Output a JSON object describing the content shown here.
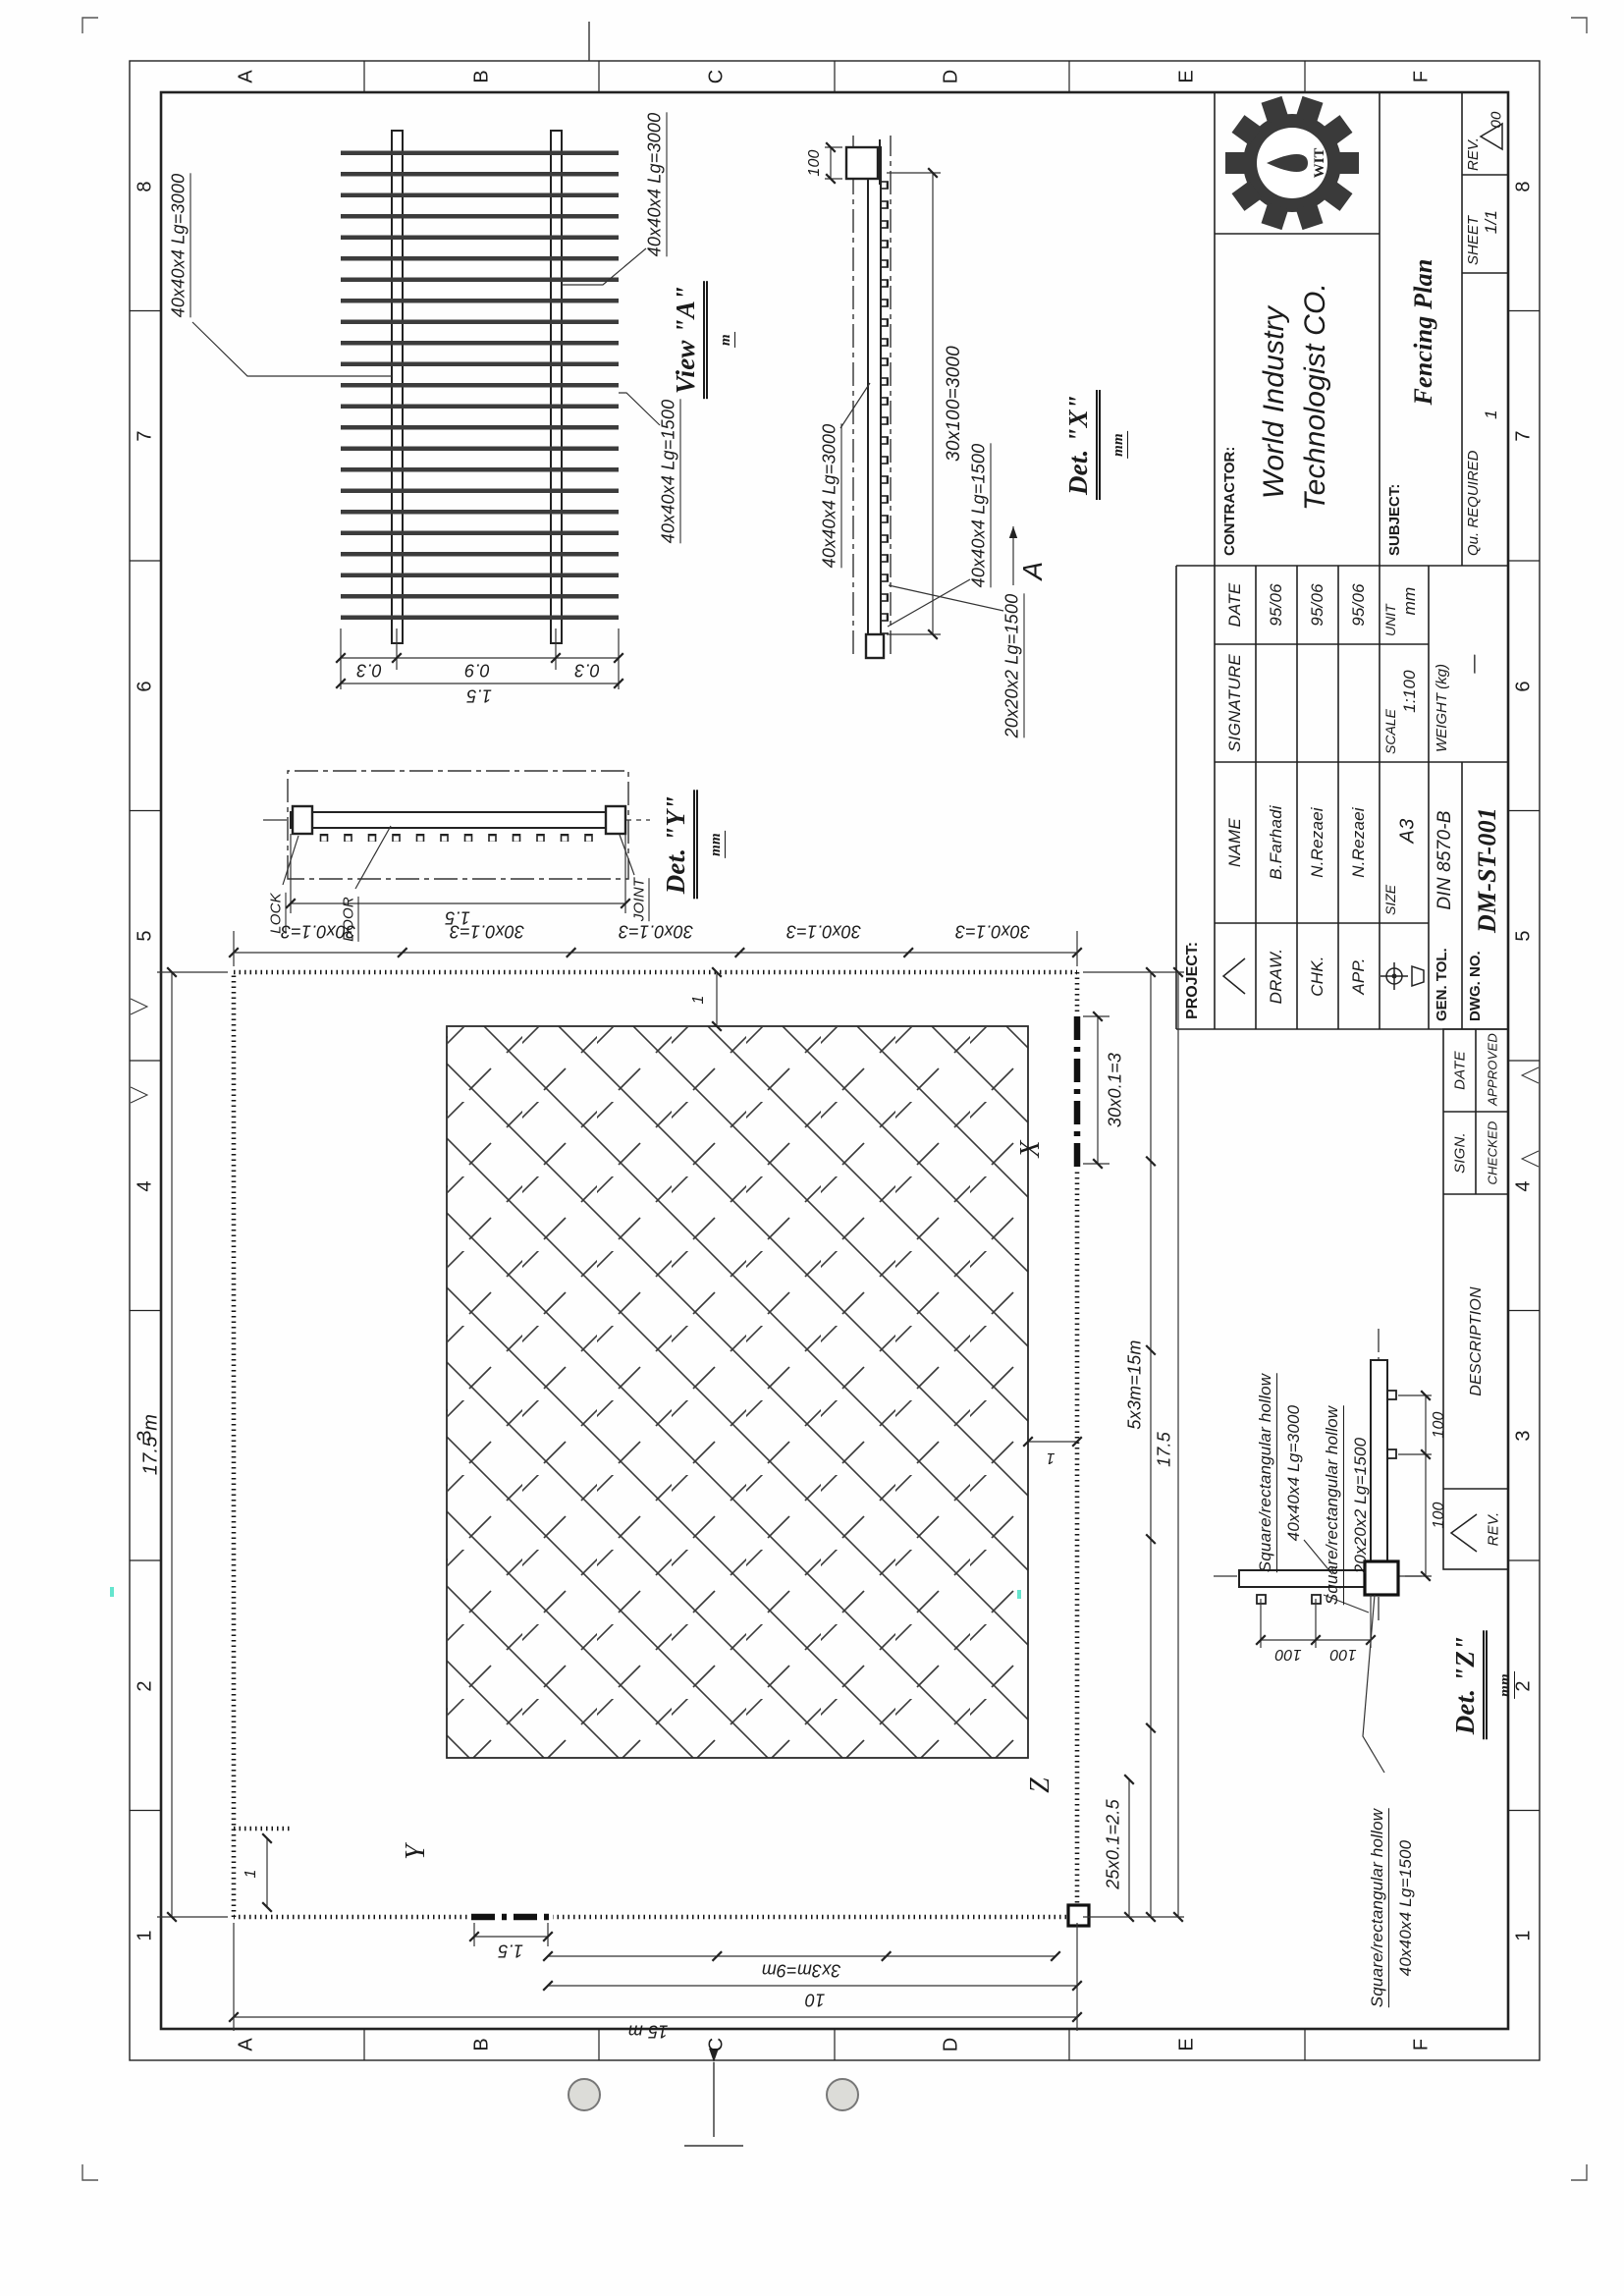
{
  "sheet": {
    "grid_letters": [
      "A",
      "B",
      "C",
      "D",
      "E",
      "F"
    ],
    "grid_numbers": [
      "1",
      "2",
      "3",
      "4",
      "5",
      "6",
      "7",
      "8"
    ]
  },
  "title_block": {
    "project_label": "PROJECT:",
    "contractor_label": "CONTRACTOR:",
    "contractor_name_line1": "World Industry",
    "contractor_name_line2": "Technologist CO.",
    "logo_text": "WIT",
    "logo_icon": "gear-drop-icon",
    "subject_label": "SUBJECT:",
    "subject_value": "Fencing Plan",
    "table": {
      "name_header": "NAME",
      "signature_header": "SIGNATURE",
      "date_header": "DATE",
      "rows": [
        {
          "role": "DRAW.",
          "name": "B.Farhadi",
          "date": "95/06"
        },
        {
          "role": "CHK.",
          "name": "N.Rezaei",
          "date": "95/06"
        },
        {
          "role": "APP.",
          "name": "N.Rezaei",
          "date": "95/06"
        }
      ]
    },
    "size_label": "SIZE",
    "size_value": "A3",
    "scale_label": "SCALE",
    "scale_value": "1:100",
    "unit_label": "UNIT",
    "unit_value": "mm",
    "gen_tol_label": "GEN. TOL.",
    "gen_tol_value": "DIN 8570-B",
    "weight_label": "WEIGHT (kg)",
    "weight_value": "—",
    "dwg_no_label": "DWG. NO.",
    "dwg_no_value": "DM-ST-001",
    "qu_required_label": "Qu. REQUIRED",
    "qu_required_value": "1",
    "sheet_label": "SHEET",
    "sheet_value": "1/1",
    "rev_label": "REV.",
    "rev_value": "00"
  },
  "revision_strip": {
    "rev": "REV.",
    "description": "DESCRIPTION",
    "sign": "SIGN.",
    "date": "DATE",
    "checked": "CHECKED",
    "approved": "APPROVED"
  },
  "plan": {
    "overall_width": "17.5 m",
    "right_chain": [
      "30x0.1=3",
      "30x0.1=3",
      "30x0.1=3",
      "30x0.1=3",
      "30x0.1=3"
    ],
    "gate_x_dim": "30x0.1=3",
    "bottom_dim_1": "5x3m=15m",
    "bottom_dim_2": "17.5",
    "corner_dim": "25x0.1=2.5",
    "gate_y_dim": "1.5",
    "left_dim_9m": "3x3m=9m",
    "left_dim_10": "10",
    "left_dim_15": "15 m",
    "marker_x": "X",
    "marker_y": "Y",
    "marker_z": "Z",
    "dim_one_a": "1",
    "dim_one_b": "1",
    "dim_one_c": "1"
  },
  "view_a": {
    "title": "View \"A\"",
    "unit": "m",
    "rail_label_top": "40x40x4 Lg=3000",
    "rail_label_bottom": "40x40x4 Lg=3000",
    "picket_label": "40x40x4 Lg=1500",
    "dim_top": "0.3",
    "dim_mid": "0.9",
    "dim_bot": "0.3",
    "dim_total": "1.5"
  },
  "det_y": {
    "title": "Det. \"Y\"",
    "unit": "mm",
    "lock": "LOCK",
    "door": "DOOR",
    "joint": "JOINT",
    "dim": "1.5"
  },
  "det_x": {
    "title": "Det. \"X\"",
    "unit": "mm",
    "dim_end": "100",
    "rail_label": "40x40x4 Lg=3000",
    "dim_spacing": "30x100=3000",
    "post_label": "40x40x4 Lg=1500",
    "picket_label": "20x20x2 Lg=1500",
    "view_arrow": "A"
  },
  "det_z": {
    "title": "Det. \"Z\"",
    "unit": "mm",
    "label1_line1": "Square/rectangular hollow",
    "label1_line2": "40x40x4 Lg=3000",
    "label2_line1": "Square/rectangular hollow",
    "label2_line2": "20x20x2 Lg=1500",
    "label3_line1": "Square/rectangular hollow",
    "label3_line2": "40x40x4 Lg=1500",
    "dims_100": [
      "100",
      "100",
      "100",
      "100"
    ]
  }
}
